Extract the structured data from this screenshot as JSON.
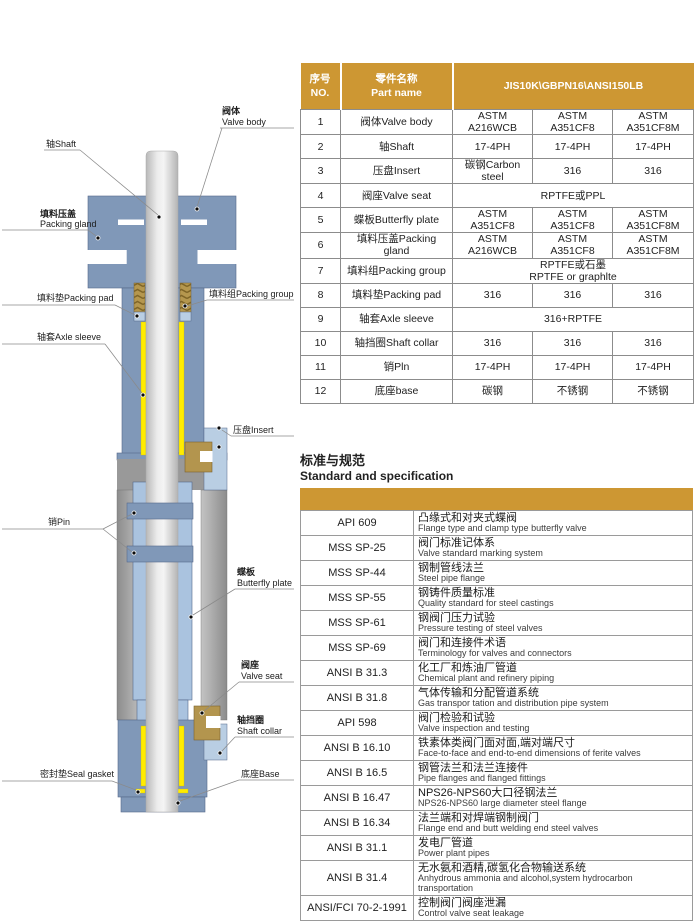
{
  "colors": {
    "gold": "#CD9733",
    "body_blue": "#8098B8",
    "light_blue": "#AAC3DF",
    "pale_blue": "#B9CEE3",
    "tan": "#B3954E",
    "yellow": "#FFEC00",
    "gray": "#9A9A9A",
    "border_gray": "#8C8C8C"
  },
  "parts_table": {
    "header": {
      "no": "序号\nNO.",
      "part_name": "零件名称\nPart name",
      "materials": "JIS10K\\GBPN16\\ANSI150LB"
    },
    "rows": [
      {
        "no": "1",
        "name": "阀体Valve body",
        "values": [
          "ASTM A216WCB",
          "ASTM A351CF8",
          "ASTM A351CF8M"
        ]
      },
      {
        "no": "2",
        "name": "轴Shaft",
        "values": [
          "17-4PH",
          "17-4PH",
          "17-4PH"
        ]
      },
      {
        "no": "3",
        "name": "压盘Insert",
        "values": [
          "碳钢Carbon steel",
          "316",
          "316"
        ]
      },
      {
        "no": "4",
        "name": "阀座Valve seat",
        "values": [
          "RPTFE或PPL"
        ]
      },
      {
        "no": "5",
        "name": "蝶板Butterfly plate",
        "values": [
          "ASTM A351CF8",
          "ASTM A351CF8",
          "ASTM A351CF8M"
        ]
      },
      {
        "no": "6",
        "name": "填料压盖Packing gland",
        "values": [
          "ASTM A216WCB",
          "ASTM A351CF8",
          "ASTM A351CF8M"
        ]
      },
      {
        "no": "7",
        "name": "填料组Packing group",
        "values": [
          "RPTFE或石墨\nRPTFE or graphlte"
        ]
      },
      {
        "no": "8",
        "name": "填料垫Packing pad",
        "values": [
          "316",
          "316",
          "316"
        ]
      },
      {
        "no": "9",
        "name": "轴套Axle sleeve",
        "values": [
          "316+RPTFE"
        ]
      },
      {
        "no": "10",
        "name": "轴挡圈Shaft collar",
        "values": [
          "316",
          "316",
          "316"
        ]
      },
      {
        "no": "11",
        "name": "销Pln",
        "values": [
          "17-4PH",
          "17-4PH",
          "17-4PH"
        ]
      },
      {
        "no": "12",
        "name": "底座base",
        "values": [
          "碳钢",
          "不锈钢",
          "不锈钢"
        ]
      }
    ]
  },
  "standards": {
    "title_zh": "标准与规范",
    "title_en": "Standard and specification",
    "rows": [
      {
        "code": "API 609",
        "zh": "凸缘式和对夹式蝶阀",
        "en": "Flange type and clamp type butterfly valve"
      },
      {
        "code": "MSS SP-25",
        "zh": "阀门标准记体系",
        "en": "Valve standard marking system"
      },
      {
        "code": "MSS SP-44",
        "zh": "钢制管线法兰",
        "en": "Steel pipe flange"
      },
      {
        "code": "MSS SP-55",
        "zh": "钢铸件质量标准",
        "en": "Quality standard for steel castings"
      },
      {
        "code": "MSS SP-61",
        "zh": "钢阀门压力试验",
        "en": "Pressure testing of steel valves"
      },
      {
        "code": "MSS SP-69",
        "zh": "阀门和连接件术语",
        "en": "Terminology for valves and connectors"
      },
      {
        "code": "ANSI B 31.3",
        "zh": "化工厂和炼油厂管道",
        "en": "Chemical plant and refinery piping"
      },
      {
        "code": "ANSI B 31.8",
        "zh": "气体传输和分配管道系统",
        "en": "Gas transpor tation and distribution pipe system"
      },
      {
        "code": "API 598",
        "zh": "阀门检验和试验",
        "en": "Valve inspection and testing"
      },
      {
        "code": "ANSI B 16.10",
        "zh": "铁素体类阀门面对面,端对端尺寸",
        "en": "Face-to-face and end-to-end dimensions of ferite valves"
      },
      {
        "code": "ANSI B 16.5",
        "zh": "钢管法兰和法兰连接件",
        "en": "Pipe flanges and flanged fittings"
      },
      {
        "code": "ANSI B 16.47",
        "zh": "NPS26-NPS60大口径钢法兰",
        "en": "NPS26-NPS60 large diameter steel flange"
      },
      {
        "code": "ANSI B 16.34",
        "zh": "法兰端和对焊端钢制阀门",
        "en": "Flange end and butt welding end steel valves"
      },
      {
        "code": "ANSI B 31.1",
        "zh": "发电厂管道",
        "en": "Power plant pipes"
      },
      {
        "code": "ANSI B 31.4",
        "zh": "无水氨和酒精,碳氢化合物输送系统",
        "en": "Anhydrous ammonia and alcohol,system hydrocarbon transportation"
      },
      {
        "code": "ANSI/FCI 70-2-1991",
        "zh": "控制阀门阀座泄漏",
        "en": "Control valve seat leakage"
      }
    ]
  },
  "diagram": {
    "labels": {
      "shaft": "轴Shaft",
      "valve_body_zh": "阀体",
      "valve_body_en": "Valve body",
      "packing_gland_zh": "填料压盖",
      "packing_gland_en": "Packing gland",
      "packing_pad": "填料垫Packing pad",
      "packing_group": "填料组Packing group",
      "axle_sleeve": "轴套Axle sleeve",
      "insert": "压盘Insert",
      "pin": "销Pin",
      "butterfly_zh": "蝶板",
      "butterfly_en": "Butterfly plate",
      "valve_seat_zh": "阀座",
      "valve_seat_en": "Valve seat",
      "shaft_collar_zh": "轴挡圈",
      "shaft_collar_en": "Shaft collar",
      "seal_gasket": "密封垫Seal gasket",
      "base": "底座Base"
    }
  }
}
